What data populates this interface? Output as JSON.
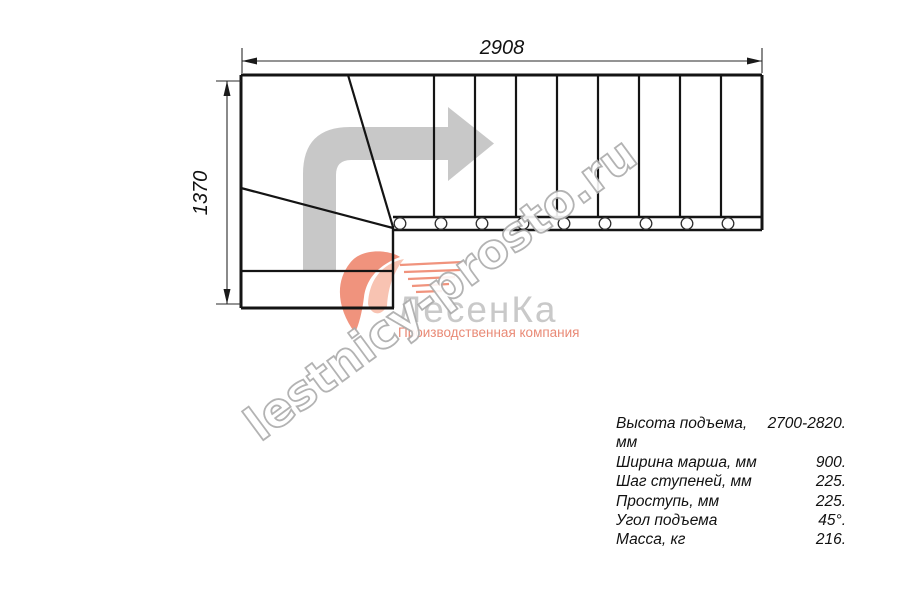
{
  "dimensions": {
    "width_mm": "2908",
    "height_mm": "1370"
  },
  "specs": {
    "rows": [
      {
        "label": "Высота подъема, мм",
        "value": "2700-2820."
      },
      {
        "label": "Ширина марша, мм",
        "value": "900."
      },
      {
        "label": "Шаг ступеней, мм",
        "value": "225."
      },
      {
        "label": "Проступь, мм",
        "value": "225."
      },
      {
        "label": "Угол подъема",
        "value": "45°."
      },
      {
        "label": "Масса, кг",
        "value": "216."
      }
    ]
  },
  "watermark": {
    "site": "lestnicy-prosto.ru"
  },
  "logo": {
    "name": "ЛесенКа",
    "tagline": "Производственная компания"
  },
  "colors": {
    "arrow_gray": "#c8c8c8",
    "line_black": "#141414",
    "logo_coral": "#f0937d",
    "logo_coral_light": "#f8c3b2",
    "logo_text_gray": "#c9c9c9",
    "tagline_coral": "#e98a76",
    "watermark_stroke": "#ababab",
    "watermark_fill": "#ffffff"
  }
}
